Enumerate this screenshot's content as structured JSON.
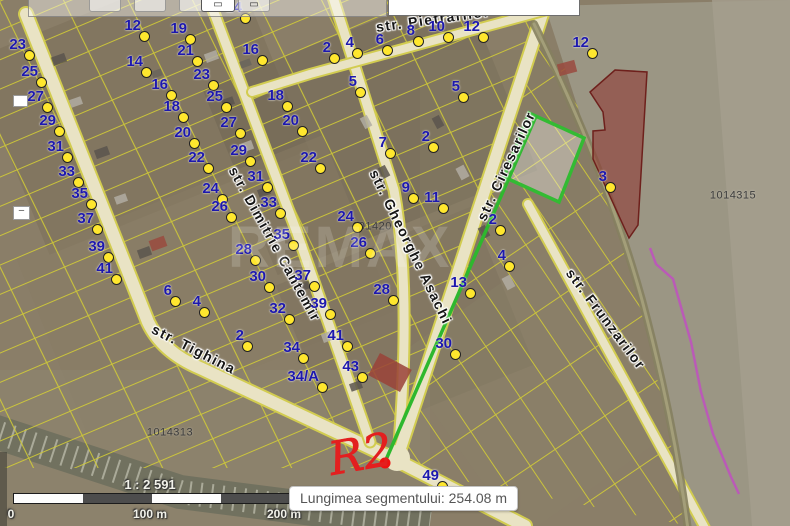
{
  "toolbar": {
    "measure_button_icon": "▭",
    "secondary_button_icon": "▭"
  },
  "map_controls": {
    "zoom_out_glyph": "−"
  },
  "map": {
    "watermark": "REMAX",
    "annotation": {
      "text": "R2",
      "color": "#e31f1f"
    },
    "measurement": {
      "x1": 536,
      "y1": 116,
      "x2": 385,
      "y2": 462,
      "line_color": "#2eb82e",
      "endpoint_color": "#ee1111"
    },
    "streets": [
      {
        "name": "str. Pietrarilor",
        "x": 433,
        "y": 19,
        "rot": -8
      },
      {
        "name": "str. Gheorghe Asachi",
        "x": 411,
        "y": 247,
        "rot": 64
      },
      {
        "name": "str. Ciresarilor",
        "x": 506,
        "y": 166,
        "rot": -65
      },
      {
        "name": "str. Dimitrie Cantemir",
        "x": 275,
        "y": 244,
        "rot": 61
      },
      {
        "name": "str. Tighina",
        "x": 194,
        "y": 349,
        "rot": 27
      },
      {
        "name": "str. Frunzarilor",
        "x": 606,
        "y": 319,
        "rot": 53
      }
    ],
    "parcel_ids": [
      {
        "id": "1014315",
        "x": 733,
        "y": 196
      },
      {
        "id": "1014313",
        "x": 170,
        "y": 433
      },
      {
        "id": "101420",
        "x": 372,
        "y": 227
      }
    ],
    "markers": [
      {
        "n": "23",
        "x": 29,
        "y": 55
      },
      {
        "n": "25",
        "x": 41,
        "y": 82
      },
      {
        "n": "27",
        "x": 47,
        "y": 107
      },
      {
        "n": "29",
        "x": 59,
        "y": 131
      },
      {
        "n": "31",
        "x": 67,
        "y": 157
      },
      {
        "n": "33",
        "x": 78,
        "y": 182
      },
      {
        "n": "35",
        "x": 91,
        "y": 204
      },
      {
        "n": "37",
        "x": 97,
        "y": 229
      },
      {
        "n": "39",
        "x": 108,
        "y": 257
      },
      {
        "n": "41",
        "x": 116,
        "y": 279
      },
      {
        "n": "12",
        "x": 144,
        "y": 36
      },
      {
        "n": "14",
        "x": 146,
        "y": 72
      },
      {
        "n": "16",
        "x": 171,
        "y": 95
      },
      {
        "n": "18",
        "x": 183,
        "y": 117
      },
      {
        "n": "20",
        "x": 194,
        "y": 143
      },
      {
        "n": "22",
        "x": 208,
        "y": 168
      },
      {
        "n": "24",
        "x": 222,
        "y": 199
      },
      {
        "n": "19",
        "x": 190,
        "y": 39
      },
      {
        "n": "21",
        "x": 197,
        "y": 61
      },
      {
        "n": "23",
        "x": 213,
        "y": 85
      },
      {
        "n": "25",
        "x": 226,
        "y": 107
      },
      {
        "n": "27",
        "x": 240,
        "y": 133
      },
      {
        "n": "29",
        "x": 250,
        "y": 161
      },
      {
        "n": "31",
        "x": 267,
        "y": 187
      },
      {
        "n": "33",
        "x": 280,
        "y": 213
      },
      {
        "n": "35",
        "x": 293,
        "y": 245
      },
      {
        "n": "37",
        "x": 314,
        "y": 286
      },
      {
        "n": "39",
        "x": 330,
        "y": 314
      },
      {
        "n": "41",
        "x": 347,
        "y": 346
      },
      {
        "n": "43",
        "x": 362,
        "y": 377
      },
      {
        "n": "16",
        "x": 262,
        "y": 60
      },
      {
        "n": "18",
        "x": 287,
        "y": 106
      },
      {
        "n": "20",
        "x": 302,
        "y": 131
      },
      {
        "n": "22",
        "x": 320,
        "y": 168
      },
      {
        "n": "26",
        "x": 231,
        "y": 217
      },
      {
        "n": "28",
        "x": 255,
        "y": 260
      },
      {
        "n": "30",
        "x": 269,
        "y": 287
      },
      {
        "n": "32",
        "x": 289,
        "y": 319
      },
      {
        "n": "6",
        "x": 175,
        "y": 301
      },
      {
        "n": "4",
        "x": 204,
        "y": 312
      },
      {
        "n": "2",
        "x": 247,
        "y": 346
      },
      {
        "n": "34",
        "x": 303,
        "y": 358
      },
      {
        "n": "34/A",
        "x": 322,
        "y": 387
      },
      {
        "n": "14",
        "x": 245,
        "y": 18
      },
      {
        "n": "2",
        "x": 334,
        "y": 58
      },
      {
        "n": "4",
        "x": 357,
        "y": 53
      },
      {
        "n": "6",
        "x": 387,
        "y": 50
      },
      {
        "n": "8",
        "x": 418,
        "y": 41
      },
      {
        "n": "10",
        "x": 448,
        "y": 37
      },
      {
        "n": "12",
        "x": 483,
        "y": 37
      },
      {
        "n": "5",
        "x": 360,
        "y": 92
      },
      {
        "n": "5",
        "x": 463,
        "y": 97
      },
      {
        "n": "7",
        "x": 390,
        "y": 153
      },
      {
        "n": "2",
        "x": 433,
        "y": 147
      },
      {
        "n": "9",
        "x": 413,
        "y": 198
      },
      {
        "n": "11",
        "x": 443,
        "y": 208
      },
      {
        "n": "24",
        "x": 357,
        "y": 227
      },
      {
        "n": "26",
        "x": 370,
        "y": 253
      },
      {
        "n": "28",
        "x": 393,
        "y": 300
      },
      {
        "n": "13",
        "x": 470,
        "y": 293
      },
      {
        "n": "2",
        "x": 500,
        "y": 230
      },
      {
        "n": "4",
        "x": 509,
        "y": 266
      },
      {
        "n": "30",
        "x": 455,
        "y": 354
      },
      {
        "n": "12",
        "x": 592,
        "y": 53
      },
      {
        "n": "3",
        "x": 610,
        "y": 187
      },
      {
        "n": "49",
        "x": 442,
        "y": 486
      }
    ]
  },
  "tooltip": {
    "text": "Lungimea segmentului: 254.08 m"
  },
  "scalebar": {
    "ratio": "1 : 2 591",
    "ticks": [
      "0",
      "100 m",
      "200 m"
    ]
  },
  "colors": {
    "marker_fill": "#ffe72e",
    "marker_number": "#1d18ad",
    "parcel_line": "#d6d034",
    "measure_green": "#2eb82e",
    "endpoint_red": "#ee1111",
    "highlight_parcel_green": "#33bb33",
    "restricted_zone_red": "#8f3a35",
    "boundary_magenta": "#c050c0"
  }
}
